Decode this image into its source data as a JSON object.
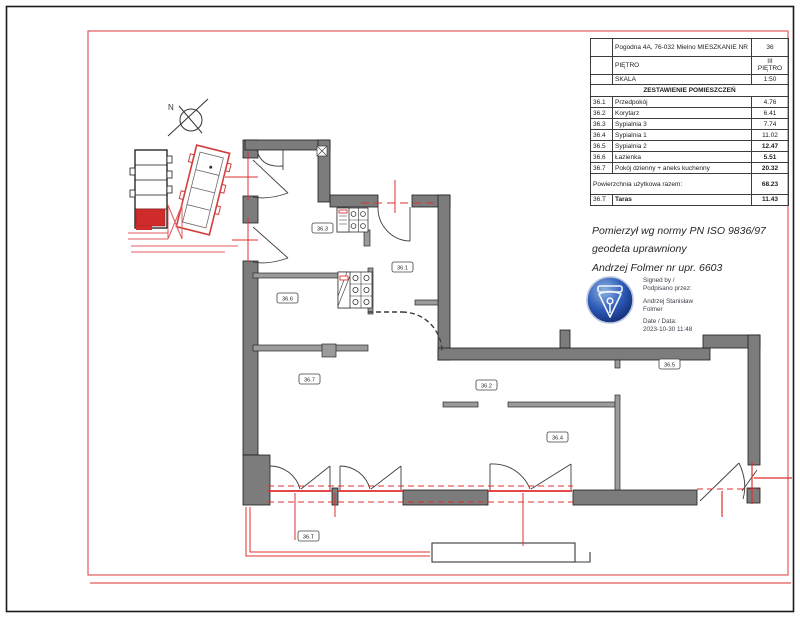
{
  "title_block": {
    "row_address": {
      "label": "Pogodna 4A, 76-032 Mielno MIESZKANIE NR",
      "value": "36"
    },
    "row_floor": {
      "label": "PIĘTRO",
      "value_line1": "III",
      "value_line2": "PIĘTRO"
    },
    "row_scale": {
      "label": "SKALA",
      "value": "1:50"
    },
    "header": "ZESTAWIENIE POMIESZCZEŃ",
    "rooms": [
      {
        "no": "36.1",
        "name": "Przedpokój",
        "area": "4.76"
      },
      {
        "no": "36.2",
        "name": "Korytarz",
        "area": "6.41"
      },
      {
        "no": "36.3",
        "name": "Sypialnia 3",
        "area": "7.74"
      },
      {
        "no": "36.4",
        "name": "Sypialnia 1",
        "area": "11.02"
      },
      {
        "no": "36.5",
        "name": "Sypialnia 2",
        "area": "12.47"
      },
      {
        "no": "36.6",
        "name": "Łazienka",
        "area": "5.51"
      },
      {
        "no": "36.7",
        "name": "Pokój dzienny + aneks kuchenny",
        "area": "20.32"
      }
    ],
    "total": {
      "label": "Powierzchnia użytkowa razem:",
      "area": "68.23"
    },
    "terrace": {
      "no": "36.T",
      "name": "Taras",
      "area": "11.43"
    }
  },
  "surveyor_note": {
    "line1": "Pomierzył wg normy  PN ISO 9836/97",
    "line2": "geodeta uprawniony",
    "line3": "Andrzej Folmer nr upr. 6603"
  },
  "signature": {
    "signed_by_en": "Signed by /",
    "signed_by_pl": "Podpisano przez:",
    "name_line1": "Andrzej Stanisław",
    "name_line2": "Folmer",
    "date_label": "Date / Data:",
    "date_value": "2023-10-30 11:48"
  },
  "plan": {
    "north_label": "N",
    "room_labels": [
      {
        "text": "36.3"
      },
      {
        "text": "36.1"
      },
      {
        "text": "36.6"
      },
      {
        "text": "36.7"
      },
      {
        "text": "36.2"
      },
      {
        "text": "36.5"
      },
      {
        "text": "36.4"
      },
      {
        "text": "36.T"
      }
    ]
  },
  "colors": {
    "wall_gray": "#7c7c7c",
    "accent_red": "#e12f2f",
    "stamp_blue": "#2d5cb8"
  }
}
